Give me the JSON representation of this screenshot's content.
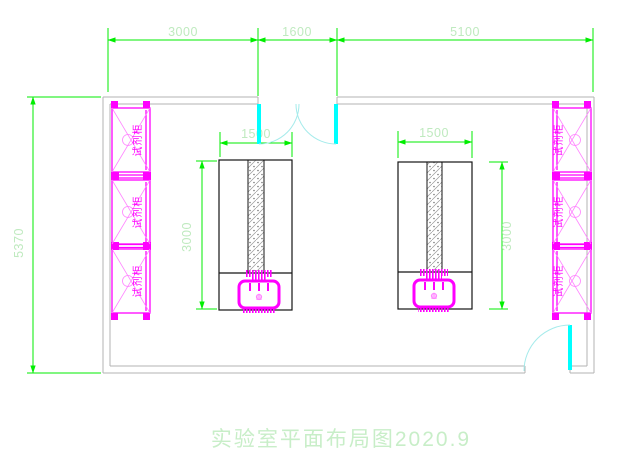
{
  "drawing_title": "实验室平面布局图2020.9",
  "dimensions": {
    "top_left": "3000",
    "top_middle": "1600",
    "top_right": "5100",
    "left_overall": "5370",
    "bench_left_width": "1500",
    "bench_left_depth": "3000",
    "bench_right_width": "1500",
    "bench_right_depth": "3000"
  },
  "labels": {
    "cabinet": "试剂柜"
  },
  "colors": {
    "dimension_line": "#00ee00",
    "dimension_text": "#bfeabf",
    "cabinet_magenta": "#ff00ff",
    "cabinet_light_magenta": "#ff85ff",
    "door_panel_cyan": "#00ffff",
    "door_swing_arc": "#a5ebeb",
    "wall_gray": "#b3b3b3",
    "bench_outline": "#151515",
    "hatch_gray": "#9a9a9a",
    "background": "#ffffff"
  }
}
